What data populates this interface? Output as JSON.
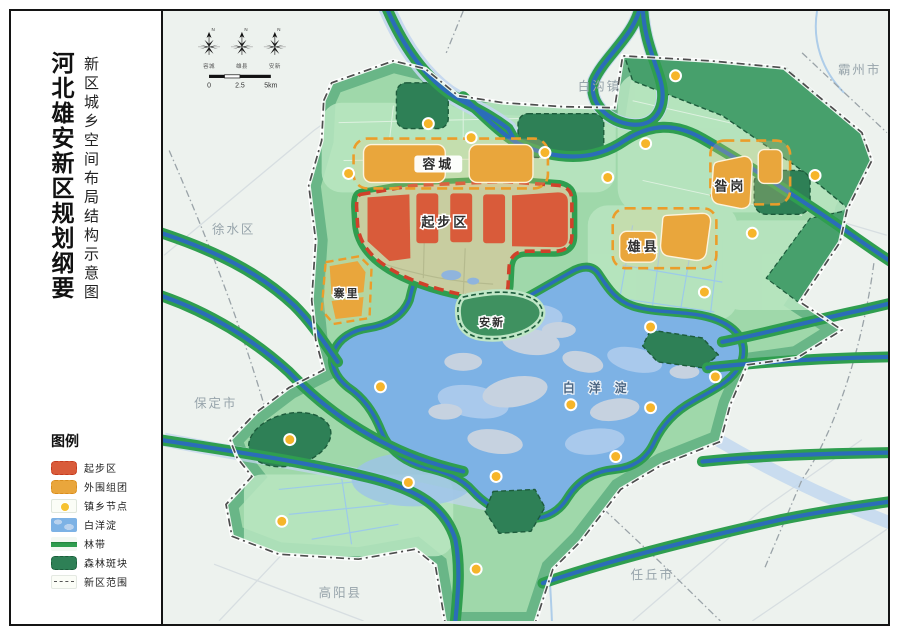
{
  "sidebar": {
    "title": "河北雄安新区规划纲要",
    "subtitle": "新区城乡空间布局结构示意图",
    "legend": {
      "title": "图例",
      "items": [
        {
          "label": "起步区"
        },
        {
          "label": "外围组团"
        },
        {
          "label": "镇乡节点"
        },
        {
          "label": "白洋淀"
        },
        {
          "label": "林带"
        },
        {
          "label": "森林斑块"
        },
        {
          "label": "新区范围"
        }
      ]
    }
  },
  "map": {
    "compass": {
      "north": "N",
      "labels": [
        "容城",
        "雄县",
        "安新"
      ]
    },
    "scalebar": {
      "ticks": [
        "0",
        "2.5",
        "5km"
      ]
    },
    "area_labels": {
      "rongcheng": "容城",
      "qibuqu": "起步区",
      "zangang": "昝岗",
      "xiongxian": "雄县",
      "zhaili": "寨里",
      "anxin": "安新",
      "baiyangdian": "白洋淀"
    },
    "city_labels": {
      "baigou": "白沟镇",
      "bazhou": "霸州市",
      "xushui": "徐水区",
      "baoding": "保定市",
      "gaoyang": "高阳县",
      "renqiu": "任丘市"
    },
    "colors": {
      "start_area_red": "#d95b3a",
      "start_area_border": "#c9391f",
      "cluster_orange": "#e9a63c",
      "cluster_border": "#e0941f",
      "node_yellow": "#f6c231",
      "lake_blue": "#7db2e5",
      "belt_green": "#2f9e4f",
      "river_blue": "#2b6db8",
      "forest_dark": "#2e8056",
      "area_green": "#9fd8aa",
      "outside_bg": "#edf2ee",
      "boundary_dash": "#4d4d4d"
    }
  }
}
